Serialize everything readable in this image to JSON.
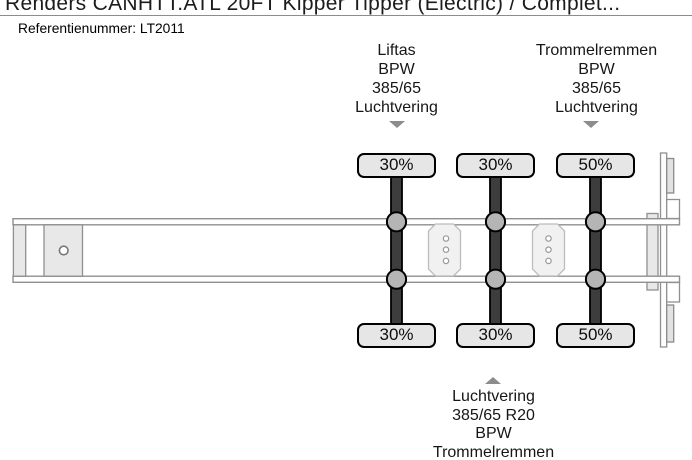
{
  "header": {
    "title": "Renders CANHTT.ATL 20FT Kipper Tipper (Electric) / Complet...",
    "reference": "Referentienummer: LT2011"
  },
  "annotations": {
    "top_left": {
      "pointer_icon": "chevron-down-icon",
      "lines": [
        "Liftas",
        "BPW",
        "385/65",
        "Luchtvering"
      ]
    },
    "top_right": {
      "pointer_icon": "chevron-down-icon",
      "lines": [
        "Trommelremmen",
        "BPW",
        "385/65",
        "Luchtvering"
      ]
    },
    "bottom": {
      "pointer_icon": "chevron-up-icon",
      "lines": [
        "Luchtvering",
        "385/65 R20",
        "BPW",
        "Trommelremmen"
      ]
    }
  },
  "diagram": {
    "kind": "trailer-axle-top-view",
    "axle_count": 3,
    "axle_loads": {
      "top": [
        "30%",
        "30%",
        "50%"
      ],
      "bottom": [
        "30%",
        "30%",
        "50%"
      ]
    }
  },
  "colors": {
    "tire_fill": "#e6e6e6",
    "axle_bar": "#3d3d3d",
    "suspension_mount": "#b5b5b5",
    "chassis_stroke": "#909090",
    "arrow": "#8c8c8c",
    "text": "#1a1a1a"
  }
}
